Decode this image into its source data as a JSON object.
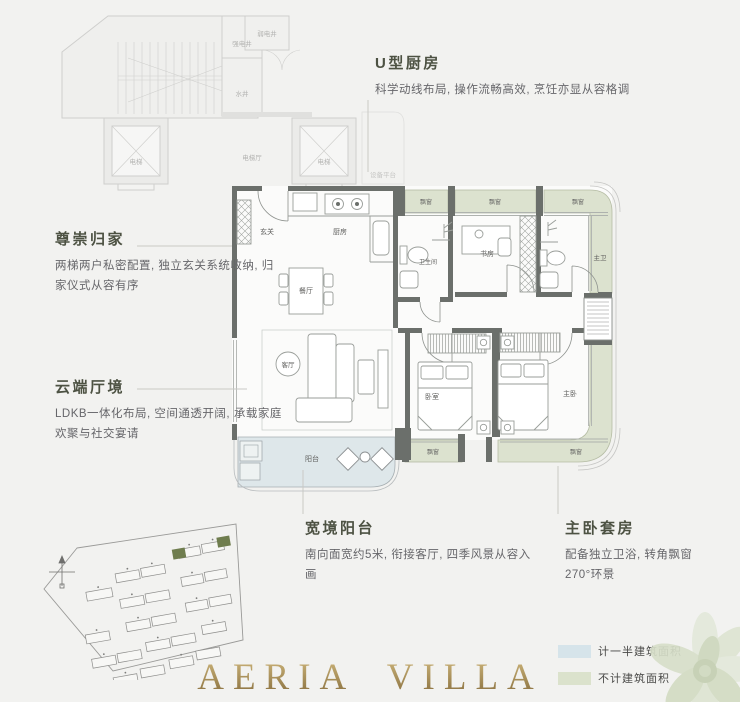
{
  "annotations": {
    "kitchen": {
      "title": "U型厨房",
      "desc": "科学动线布局, 操作流畅高效, 烹饪亦显从容格调"
    },
    "arrival": {
      "title": "尊崇归家",
      "desc": "两梯两户私密配置, 独立玄关系统收纳, 归家仪式从容有序"
    },
    "living": {
      "title": "云端厅境",
      "desc": "LDKB一体化布局, 空间通透开阔, 承载家庭欢聚与社交宴请"
    },
    "balcony": {
      "title": "宽境阳台",
      "desc": "南向面宽约5米, 衔接客厅, 四季风景从容入画"
    },
    "master": {
      "title": "主卧套房",
      "desc": "配备独立卫浴, 转角飘窗",
      "desc2": "270°环景"
    }
  },
  "plan": {
    "rooms": {
      "entry": "玄关",
      "kitchen": "厨房",
      "dining": "餐厅",
      "bath": "卫生间",
      "study": "书房",
      "master_bath": "主卫",
      "living": "客厅",
      "bedroom": "卧室",
      "master_bedroom": "主卧",
      "balcony": "阳台"
    },
    "bay_label": "飘窗",
    "common": {
      "elevator": "电梯",
      "elevator_hall": "电梯厅",
      "shaft_strong": "强电井",
      "shaft_water": "水井",
      "shaft_weak": "弱电井",
      "equipment": "设备平台"
    }
  },
  "legend": {
    "items": [
      {
        "label": "计一半建筑面积",
        "color": "#d6e4ea"
      },
      {
        "label": "不计建筑面积",
        "color": "#dbe2cc"
      }
    ]
  },
  "brand": {
    "name": "AERIA VILLA"
  },
  "colors": {
    "background": "#f2f2f0",
    "wall": "#6b6f6b",
    "bay_window_fill": "#dce2cf",
    "balcony_fill": "#dee7ea",
    "title_text": "#4d5243",
    "body_text": "#66666a",
    "brand_gold": "#a38a52",
    "site_highlight": "#6f7d4e"
  }
}
